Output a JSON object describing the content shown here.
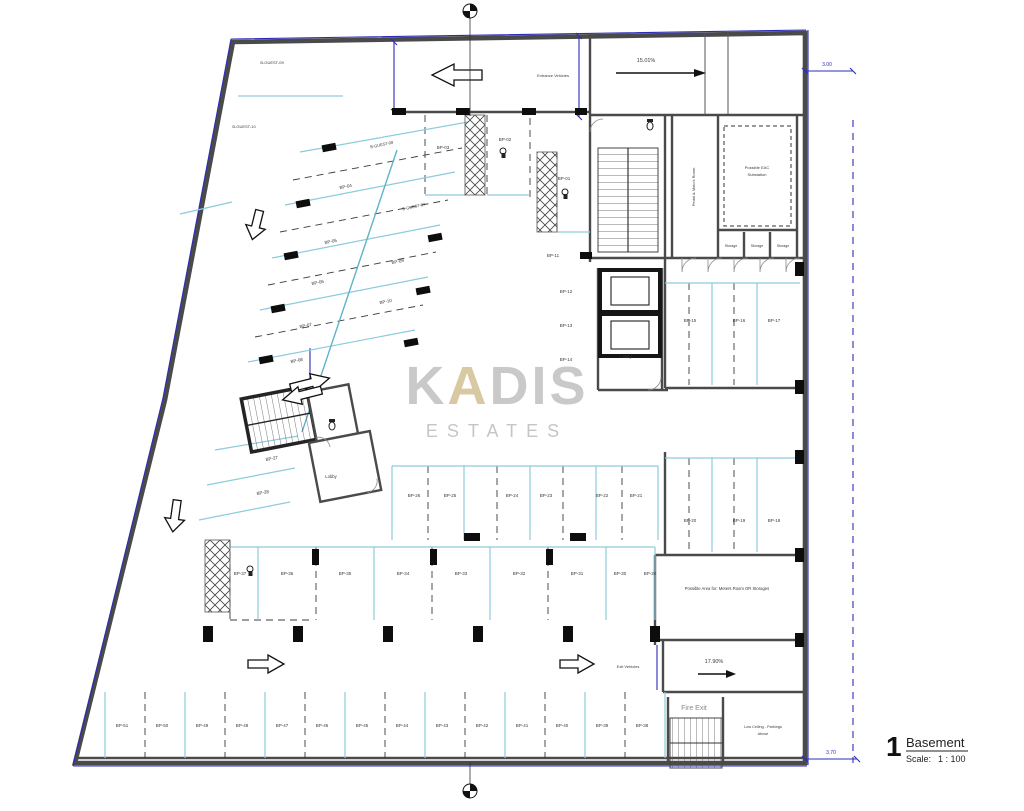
{
  "page": {
    "background": "#ffffff"
  },
  "colors": {
    "wall": "#4a4a4a",
    "parking_line": "#8ccbdc",
    "boundary_blue": "#2c2cb8",
    "watermark_gray": "#c9c9c9",
    "watermark_accent": "#d8c9a2"
  },
  "title_block": {
    "number": "1",
    "name": "Basement",
    "scale_label": "Scale:",
    "scale_value": "1 : 100"
  },
  "watermark": {
    "k": "K",
    "a": "A",
    "dis": "DIS",
    "line2": "ESTATES"
  },
  "labels": [
    {
      "t": "B-GUEST-09",
      "x": 272,
      "y": 64,
      "s": 4
    },
    {
      "t": "B-GUEST-10",
      "x": 244,
      "y": 128,
      "s": 4
    },
    {
      "t": "B-GUEST-08",
      "x": 382,
      "y": 146,
      "s": 4,
      "r": -12
    },
    {
      "t": "B-GUEST-07",
      "x": 414,
      "y": 208,
      "s": 4,
      "r": -12
    },
    {
      "t": "BP-04",
      "x": 346,
      "y": 188,
      "s": 4.5,
      "r": -12
    },
    {
      "t": "BP-05",
      "x": 331,
      "y": 243,
      "s": 4.5,
      "r": -12
    },
    {
      "t": "BP-06",
      "x": 318,
      "y": 284,
      "s": 4.5,
      "r": -12
    },
    {
      "t": "BP-07",
      "x": 306,
      "y": 327,
      "s": 4.5,
      "r": -12
    },
    {
      "t": "BP-08",
      "x": 297,
      "y": 362,
      "s": 4.5,
      "r": -12
    },
    {
      "t": "BP-09",
      "x": 398,
      "y": 263,
      "s": 4.5,
      "r": -12
    },
    {
      "t": "BP-10",
      "x": 386,
      "y": 303,
      "s": 4.5,
      "r": -12
    },
    {
      "t": "BP-03",
      "x": 443,
      "y": 149,
      "s": 4.5
    },
    {
      "t": "BP-02",
      "x": 505,
      "y": 141,
      "s": 4.5
    },
    {
      "t": "BP-01",
      "x": 564,
      "y": 180,
      "s": 4.5
    },
    {
      "t": "BP-11",
      "x": 553,
      "y": 257,
      "s": 4.5
    },
    {
      "t": "BP-12",
      "x": 566,
      "y": 293,
      "s": 4.5
    },
    {
      "t": "BP-13",
      "x": 566,
      "y": 327,
      "s": 4.5
    },
    {
      "t": "BP-14",
      "x": 566,
      "y": 361,
      "s": 4.5
    },
    {
      "t": "BP-15",
      "x": 690,
      "y": 322,
      "s": 4.5
    },
    {
      "t": "BP-16",
      "x": 739,
      "y": 322,
      "s": 4.5
    },
    {
      "t": "BP-17",
      "x": 774,
      "y": 322,
      "s": 4.5
    },
    {
      "t": "BP-20",
      "x": 690,
      "y": 522,
      "s": 4.5
    },
    {
      "t": "BP-19",
      "x": 739,
      "y": 522,
      "s": 4.5
    },
    {
      "t": "BP-18",
      "x": 774,
      "y": 522,
      "s": 4.5
    },
    {
      "t": "BP-26",
      "x": 414,
      "y": 497,
      "s": 4.5
    },
    {
      "t": "BP-25",
      "x": 450,
      "y": 497,
      "s": 4.5
    },
    {
      "t": "BP-24",
      "x": 512,
      "y": 497,
      "s": 4.5
    },
    {
      "t": "BP-23",
      "x": 546,
      "y": 497,
      "s": 4.5
    },
    {
      "t": "BP-22",
      "x": 602,
      "y": 497,
      "s": 4.5
    },
    {
      "t": "BP-21",
      "x": 636,
      "y": 497,
      "s": 4.5
    },
    {
      "t": "BP-27",
      "x": 272,
      "y": 460,
      "s": 4.5,
      "r": -10
    },
    {
      "t": "BP-28",
      "x": 263,
      "y": 494,
      "s": 4.5,
      "r": -10
    },
    {
      "t": "BP-37",
      "x": 240,
      "y": 575,
      "s": 4.5
    },
    {
      "t": "BP-36",
      "x": 287,
      "y": 575,
      "s": 4.5
    },
    {
      "t": "BP-35",
      "x": 345,
      "y": 575,
      "s": 4.5
    },
    {
      "t": "BP-34",
      "x": 403,
      "y": 575,
      "s": 4.5
    },
    {
      "t": "BP-33",
      "x": 461,
      "y": 575,
      "s": 4.5
    },
    {
      "t": "BP-32",
      "x": 519,
      "y": 575,
      "s": 4.5
    },
    {
      "t": "BP-31",
      "x": 577,
      "y": 575,
      "s": 4.5
    },
    {
      "t": "BP-30",
      "x": 620,
      "y": 575,
      "s": 4.5
    },
    {
      "t": "BP-29",
      "x": 650,
      "y": 575,
      "s": 4.5
    },
    {
      "t": "BP-51",
      "x": 122,
      "y": 727,
      "s": 4.5
    },
    {
      "t": "BP-50",
      "x": 162,
      "y": 727,
      "s": 4.5
    },
    {
      "t": "BP-49",
      "x": 202,
      "y": 727,
      "s": 4.5
    },
    {
      "t": "BP-48",
      "x": 242,
      "y": 727,
      "s": 4.5
    },
    {
      "t": "BP-47",
      "x": 282,
      "y": 727,
      "s": 4.5
    },
    {
      "t": "BP-46",
      "x": 322,
      "y": 727,
      "s": 4.5
    },
    {
      "t": "BP-45",
      "x": 362,
      "y": 727,
      "s": 4.5
    },
    {
      "t": "BP-44",
      "x": 402,
      "y": 727,
      "s": 4.5
    },
    {
      "t": "BP-43",
      "x": 442,
      "y": 727,
      "s": 4.5
    },
    {
      "t": "BP-42",
      "x": 482,
      "y": 727,
      "s": 4.5
    },
    {
      "t": "BP-41",
      "x": 522,
      "y": 727,
      "s": 4.5
    },
    {
      "t": "BP-40",
      "x": 562,
      "y": 727,
      "s": 4.5
    },
    {
      "t": "BP-39",
      "x": 602,
      "y": 727,
      "s": 4.5
    },
    {
      "t": "BP-38",
      "x": 642,
      "y": 727,
      "s": 4.5
    },
    {
      "t": "Entrance Vehicles",
      "x": 553,
      "y": 77,
      "s": 4,
      "n": "entrance-vehicles-label"
    },
    {
      "t": "15.01%",
      "x": 646,
      "y": 62,
      "s": 5.5,
      "n": "entrance-ramp-slope"
    },
    {
      "t": "17.90%",
      "x": 714,
      "y": 663,
      "s": 5.5,
      "n": "exit-ramp-slope"
    },
    {
      "t": "Exit Vehicles",
      "x": 628,
      "y": 668,
      "s": 4,
      "n": "exit-vehicles-label"
    },
    {
      "t": "Fire Exit",
      "x": 694,
      "y": 710,
      "s": 7,
      "c": "#8a8a8a",
      "n": "fire-exit-label"
    },
    {
      "t": "Possible EAC",
      "x": 757,
      "y": 169,
      "s": 4,
      "n": "eac-substation-label"
    },
    {
      "t": "Substation",
      "x": 757,
      "y": 176,
      "s": 4,
      "n": "eac-substation-label"
    },
    {
      "t": "Pedal & Moto's Room",
      "x": 695,
      "y": 187,
      "s": 4,
      "r": -90,
      "n": "moto-room-label"
    },
    {
      "t": "Storage",
      "x": 731,
      "y": 247,
      "s": 3.6,
      "n": "storage-label"
    },
    {
      "t": "Storage",
      "x": 757,
      "y": 247,
      "s": 3.6,
      "n": "storage-label"
    },
    {
      "t": "Storage",
      "x": 783,
      "y": 247,
      "s": 3.6,
      "n": "storage-label"
    },
    {
      "t": "Lobby",
      "x": 626,
      "y": 358,
      "s": 4.2,
      "n": "lobby-label"
    },
    {
      "t": "Lobby",
      "x": 331,
      "y": 478,
      "s": 4.2,
      "n": "lobby-label"
    },
    {
      "t": "Possible Area for:  Meters Room OR Storages",
      "x": 727,
      "y": 590,
      "s": 4.2,
      "n": "meters-room-label"
    },
    {
      "t": "Low Ceiling - Parkings",
      "x": 763,
      "y": 728,
      "s": 3.8,
      "n": "low-ceiling-label"
    },
    {
      "t": "Above",
      "x": 763,
      "y": 735,
      "s": 3.8,
      "n": "low-ceiling-label"
    },
    {
      "t": "3.00",
      "x": 827,
      "y": 66,
      "s": 5,
      "c": "#2c2cb8",
      "n": "dimension-label"
    },
    {
      "t": "3.70",
      "x": 831,
      "y": 754,
      "s": 5,
      "c": "#2c2cb8",
      "n": "dimension-label"
    }
  ]
}
